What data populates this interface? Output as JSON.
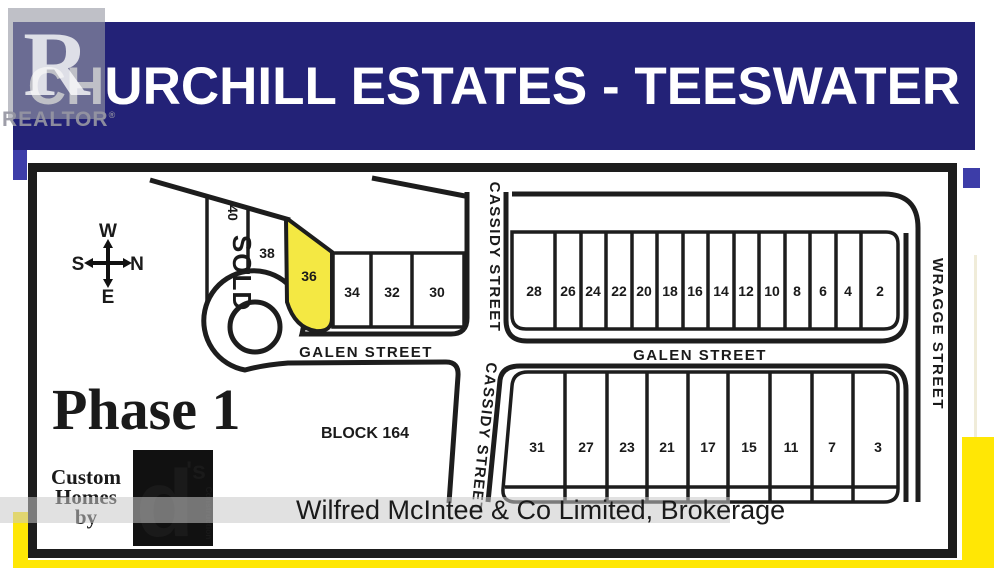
{
  "header": {
    "title": "CHURCHILL ESTATES - TEESWATER"
  },
  "realtor_watermark": {
    "letter": "R",
    "label": "REALTOR"
  },
  "map": {
    "phase": "Phase 1",
    "block": "BLOCK 164",
    "sold": "SOLD",
    "compass": {
      "top": "W",
      "bottom": "E",
      "left": "S",
      "right": "N"
    },
    "streets": {
      "galen_west": "GALEN STREET",
      "galen_east": "GALEN STREET",
      "cassidy_north": "CASSIDY STREET",
      "cassidy_south": "CASSIDY STREET",
      "wragge": "WRAGGE STREET"
    },
    "lots": {
      "cul40": "40",
      "cul38": "38",
      "cul36": "36",
      "west": [
        "34",
        "32",
        "30"
      ],
      "north": [
        "28",
        "26",
        "24",
        "22",
        "20",
        "18",
        "16",
        "14",
        "12",
        "10",
        "8",
        "6",
        "4",
        "2"
      ],
      "south": [
        "31",
        "27",
        "23",
        "21",
        "17",
        "15",
        "11",
        "7",
        "3"
      ]
    },
    "highlighted_lot": "36",
    "sold_lot": "40"
  },
  "builder": {
    "line1": "Custom",
    "line2": "Homes",
    "line3": "by",
    "logo_d": "d",
    "logo_s": "'s",
    "logo_sub": "Construction"
  },
  "watermark": {
    "text": "Wilfred McIntee & Co Limited, Brokerage"
  },
  "colors": {
    "banner_navy": "#232277",
    "highlight_yellow": "#f4e843",
    "accent_yellow": "#ffe705",
    "sold_red": "#b2363e",
    "line_black": "#1d1d1d"
  }
}
